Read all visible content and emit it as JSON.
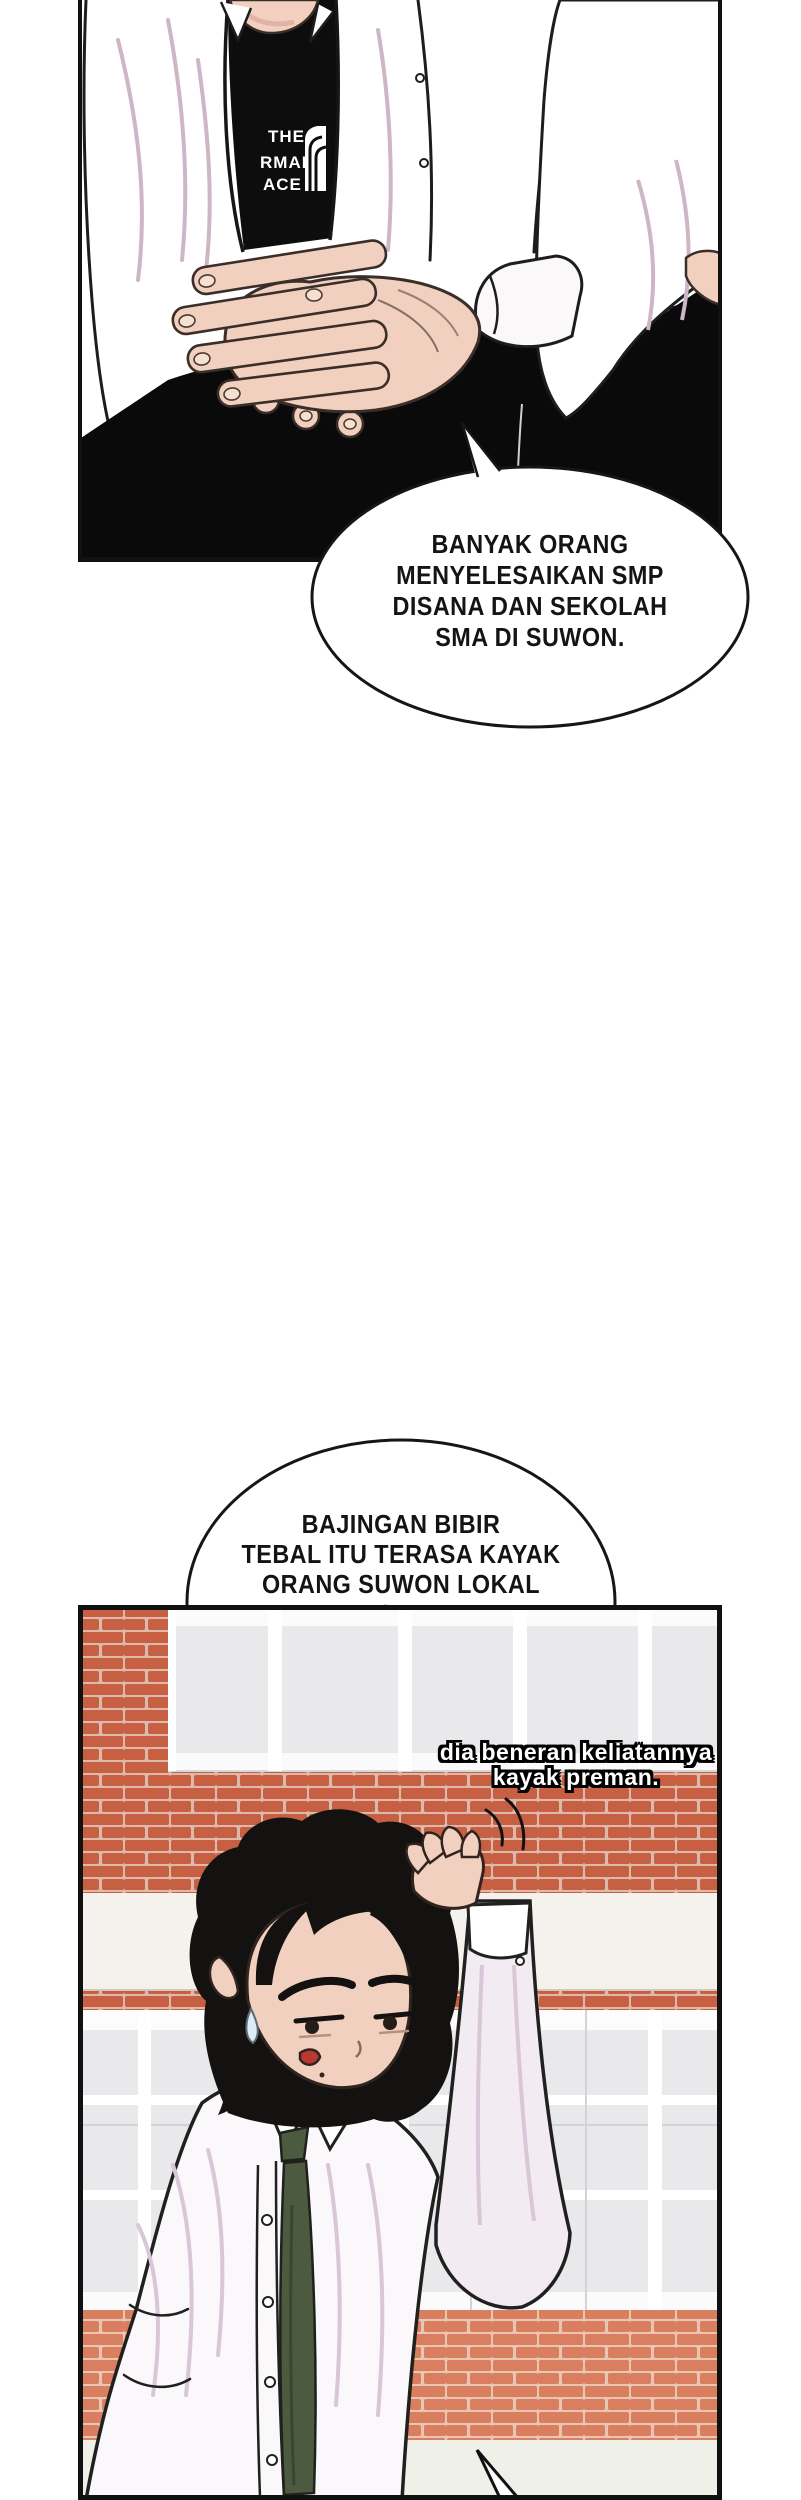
{
  "panel1": {
    "tshirt_lines": [
      "THE",
      "RMAL",
      "ACE"
    ]
  },
  "bubble1": {
    "text": "BANYAK ORANG\nMENYELESAIKAN SMP\nDISANA DAN SEKOLAH\nSMA DI SUWON."
  },
  "bubble2": {
    "text": "BAJINGAN BIBIR\nTEBAL ITU TERASA KAYAK\nORANG SUWON LOKAL\nSIH."
  },
  "caption": {
    "text": "dia beneran keliatannya\nkayak preman."
  },
  "colors": {
    "outline": "#1a1a1a",
    "skin": "#f2d0bf",
    "skin_shadow": "#e0b4a4",
    "shirt": "#ffffff",
    "shirt_fold": "#cdb6c6",
    "tee_black": "#0d0d0d",
    "pants_black": "#0a0a0a",
    "brick": "#c75f43",
    "brick_mortar": "#ddb9ab",
    "brick_sill": "#d97e5e",
    "brick_sill_mortar": "#e9c6b4",
    "concrete_band": "#f5f2ee",
    "window_glass": "#e9e9ec",
    "window_frame": "#fbfbfb",
    "tie_green": "#4c5a3f",
    "ground": "#eff0e8",
    "hair_black": "#141210",
    "sweat": "#ddecf4",
    "mouth_red": "#b9382f"
  }
}
